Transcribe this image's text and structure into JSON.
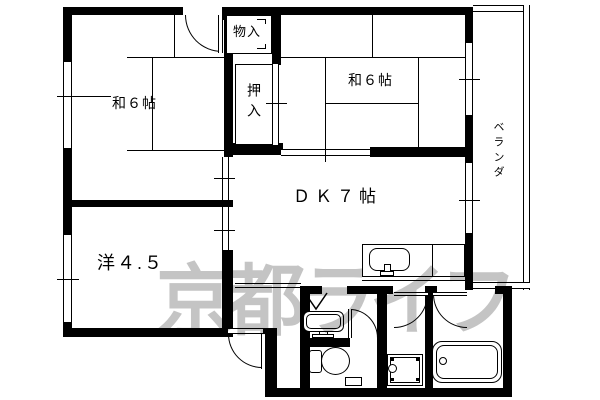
{
  "watermark": {
    "text": "京都ライフ"
  },
  "rooms": {
    "entry_storage": {
      "label": "物入"
    },
    "closet": {
      "label": "押入"
    },
    "japanese_room_left": {
      "label": "和６帖"
    },
    "japanese_room_right": {
      "label": "和６帖"
    },
    "dining_kitchen": {
      "label": "ＤＫ７帖"
    },
    "western_room": {
      "label": "洋４.５"
    },
    "veranda": {
      "label": "ベランダ"
    }
  },
  "colors": {
    "wall": "#000000",
    "background": "#ffffff",
    "watermark": "#c4c4c4"
  }
}
